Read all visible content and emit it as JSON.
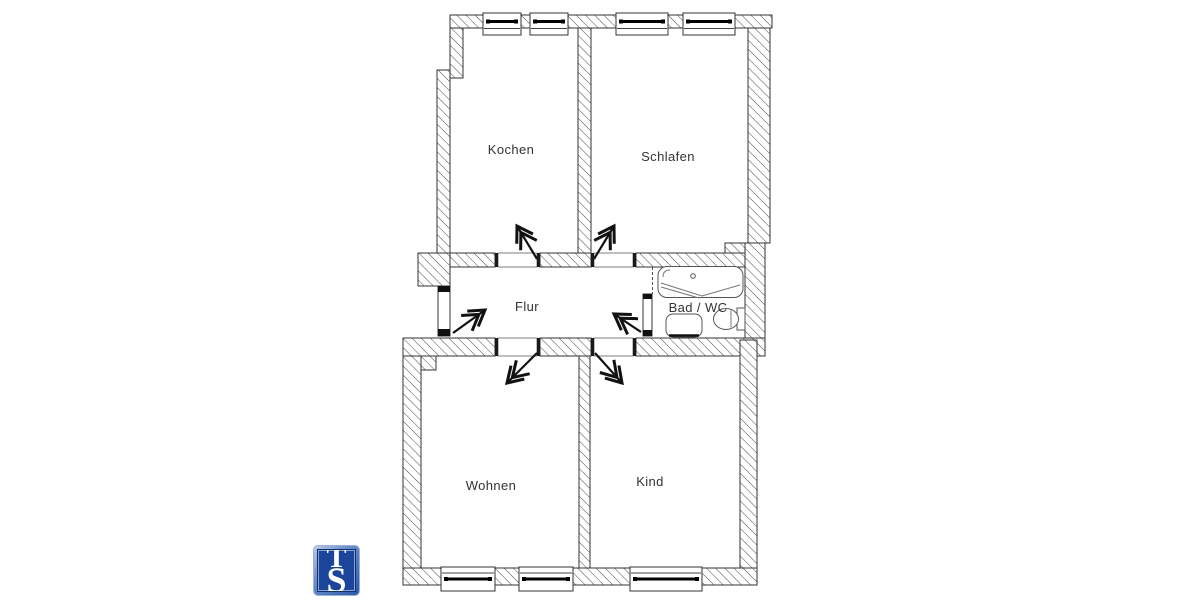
{
  "page": {
    "background_color": "#ffffff"
  },
  "floorplan": {
    "kind": "apartment-floor-plan",
    "outline_color": "#333333",
    "hatch_color": "#4a4a4a",
    "label_color": "#333333",
    "rooms": [
      {
        "id": "kochen",
        "label": "Kochen"
      },
      {
        "id": "schlafen",
        "label": "Schlafen"
      },
      {
        "id": "flur",
        "label": "Flur"
      },
      {
        "id": "bad-wc",
        "label": "Bad / WC"
      },
      {
        "id": "wohnen",
        "label": "Wohnen"
      },
      {
        "id": "kind",
        "label": "Kind"
      }
    ],
    "fixture_icons": [
      "bathtub-icon",
      "sink-icon",
      "toilet-icon"
    ],
    "window_icons": 7,
    "door_swing_icons": 6
  },
  "logo": {
    "monogram_top": "T",
    "monogram_bottom": "S",
    "panel_color": "#1b449b",
    "frame_color": "#7191cc",
    "letter_color": "#ffffff"
  }
}
